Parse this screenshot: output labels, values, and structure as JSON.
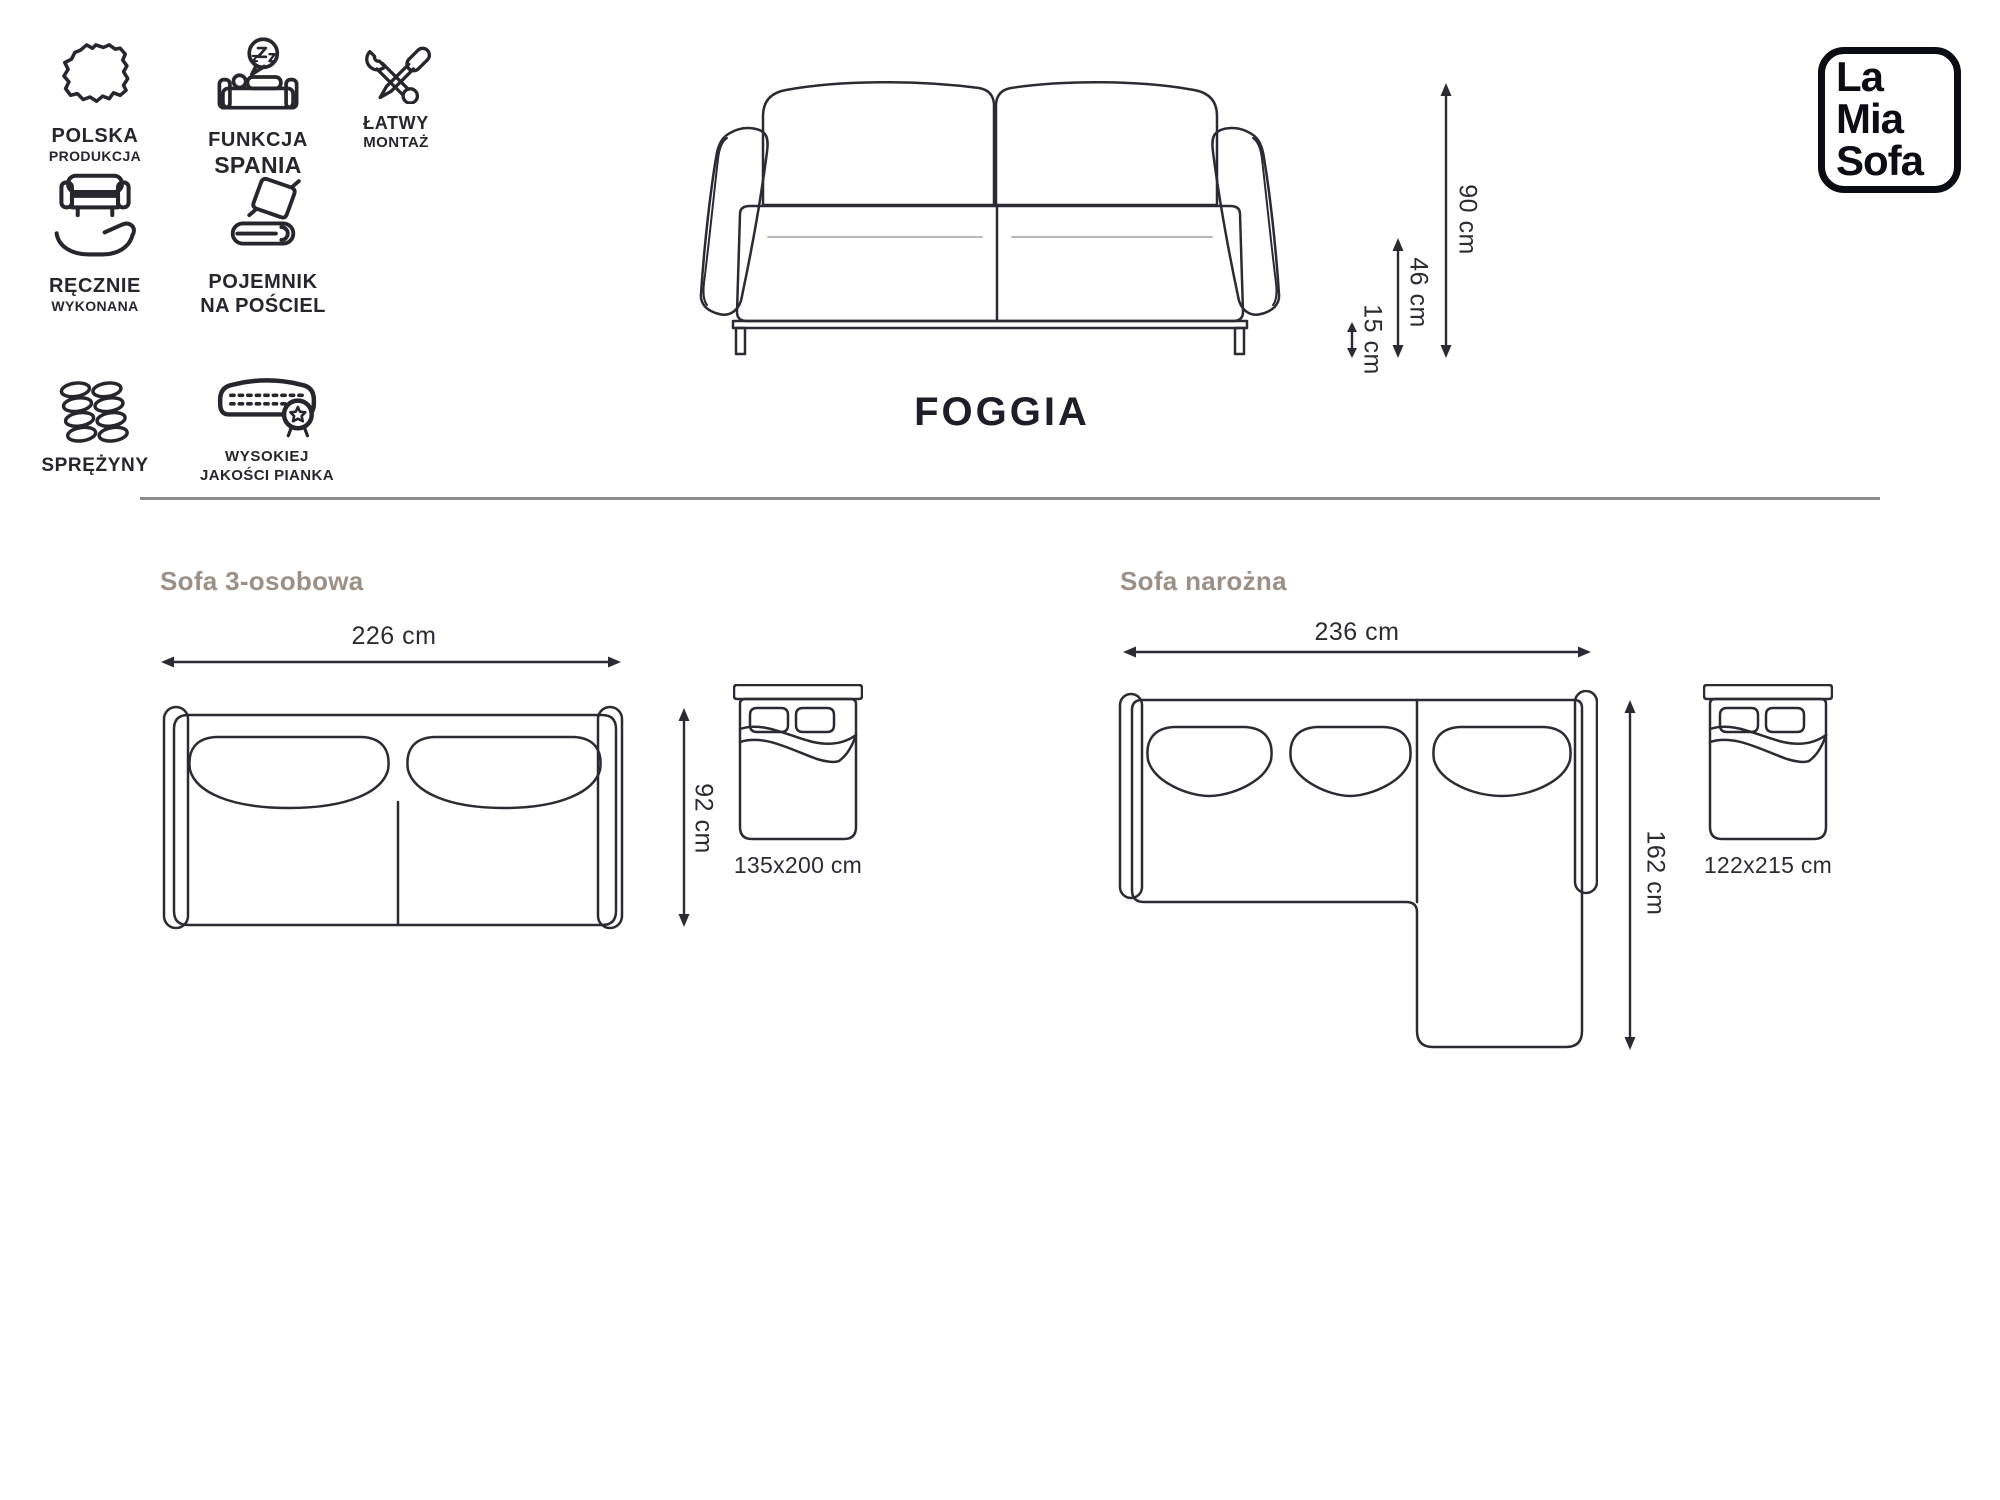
{
  "page": {
    "title": "FOGGIA"
  },
  "brand": {
    "line1": "La",
    "line2": "Mia",
    "line3": "Sofa"
  },
  "colors": {
    "ink": "#2b2b33",
    "heading": "#9c8f85",
    "divider": "#8c8c8c"
  },
  "features": [
    {
      "icon": "poland-map-icon",
      "label1": "POLSKA",
      "label2": "PRODUKCJA"
    },
    {
      "icon": "sleep-function-icon",
      "label1": "FUNKCJA",
      "label2": "SPANIA"
    },
    {
      "icon": "easy-assembly-icon",
      "label1": "ŁATWY",
      "label2": "MONTAŻ"
    },
    {
      "icon": "handmade-icon",
      "label1": "RĘCZNIE",
      "label2": "WYKONANA"
    },
    {
      "icon": "bedding-storage-icon",
      "label1": "POJEMNIK",
      "label2": "NA POŚCIEL"
    },
    {
      "icon": "springs-icon",
      "label1": "SPRĘŻYNY",
      "label2": ""
    },
    {
      "icon": "foam-quality-icon",
      "label1": "WYSOKIEJ",
      "label2": "JAKOŚCI PIANKA"
    }
  ],
  "front_view": {
    "height_total": "90 cm",
    "height_seat": "46 cm",
    "height_clearance": "15 cm"
  },
  "variants": [
    {
      "title": "Sofa 3-osobowa",
      "width": "226 cm",
      "depth": "92 cm",
      "bed_size": "135x200 cm"
    },
    {
      "title": "Sofa narożna",
      "width": "236 cm",
      "depth": "162 cm",
      "bed_size": "122x215 cm"
    }
  ]
}
